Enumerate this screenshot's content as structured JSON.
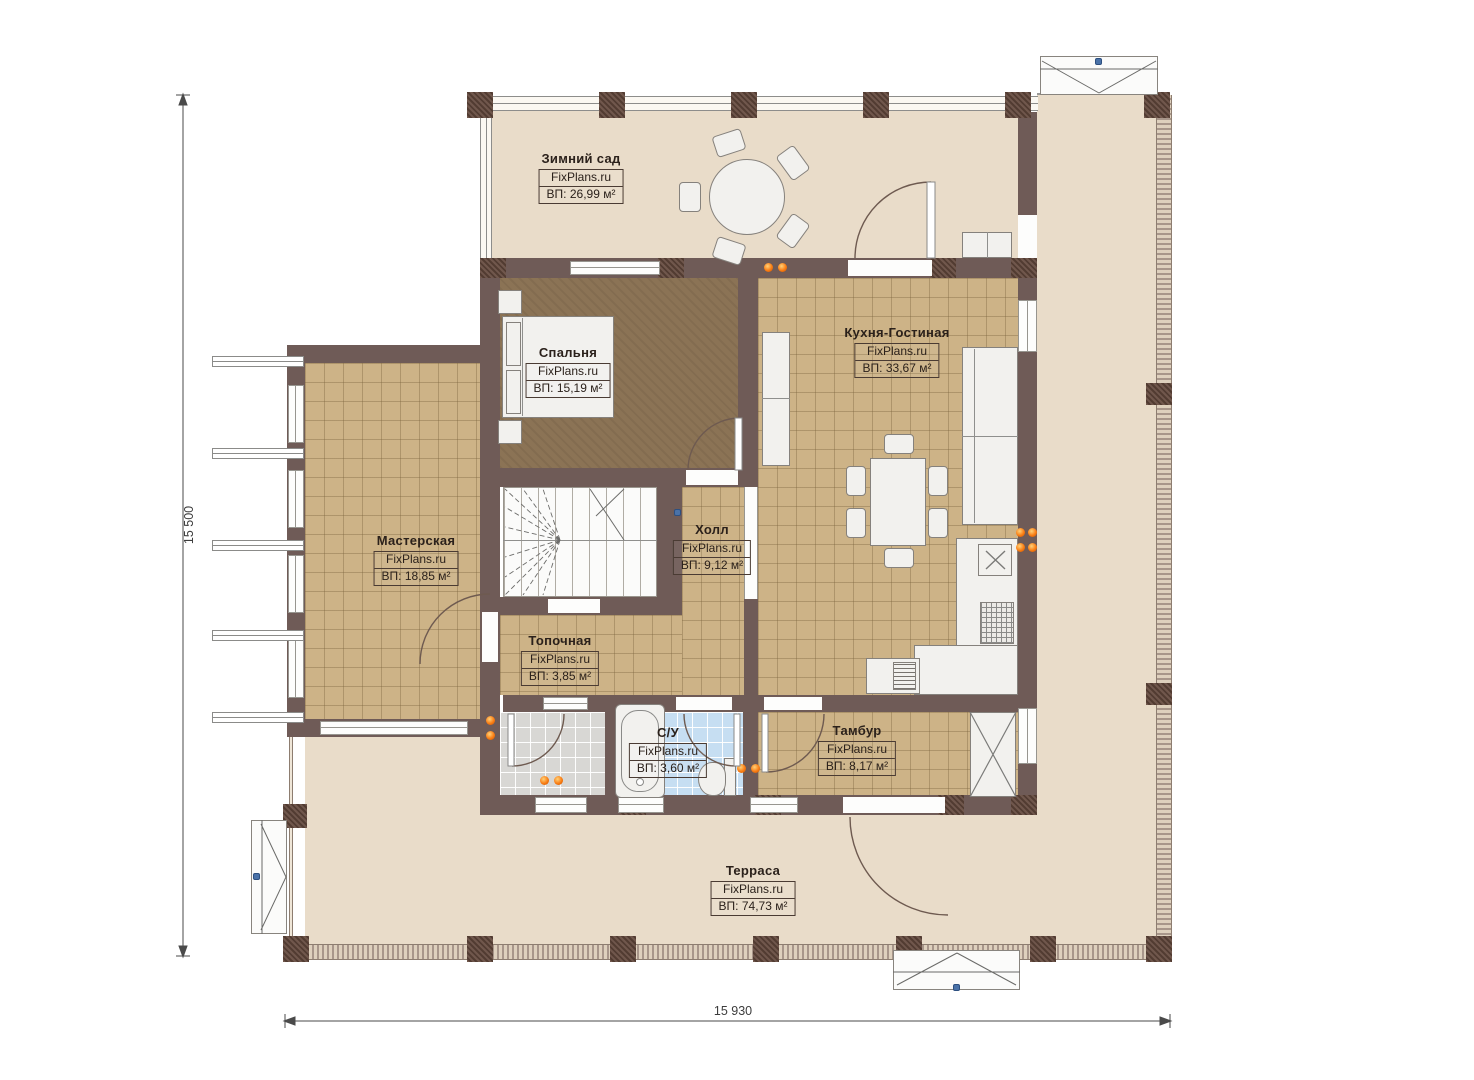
{
  "plan": {
    "brand": "FixPlans.ru",
    "rooms": [
      {
        "name": "Зимний сад",
        "watermark": "FixPlans.ru",
        "area": "ВП: 26,99 м²"
      },
      {
        "name": "Спальня",
        "watermark": "FixPlans.ru",
        "area": "ВП: 15,19 м²"
      },
      {
        "name": "Кухня-Гостиная",
        "watermark": "FixPlans.ru",
        "area": "ВП: 33,67 м²"
      },
      {
        "name": "Мастерская",
        "watermark": "FixPlans.ru",
        "area": "ВП: 18,85 м²"
      },
      {
        "name": "Холл",
        "watermark": "FixPlans.ru",
        "area": "ВП: 9,12 м²"
      },
      {
        "name": "Топочная",
        "watermark": "FixPlans.ru",
        "area": "ВП: 3,85 м²"
      },
      {
        "name": "С/У",
        "watermark": "FixPlans.ru",
        "area": "ВП: 3,60 м²"
      },
      {
        "name": "Тамбур",
        "watermark": "FixPlans.ru",
        "area": "ВП: 8,17 м²"
      },
      {
        "name": "Терраса",
        "watermark": "FixPlans.ru",
        "area": "ВП: 74,73 м²"
      }
    ],
    "dimensions": {
      "left_total": "15 500",
      "bottom_total": "15 930"
    },
    "colors": {
      "wall": "#6f5b57",
      "terrace_floor": "#e9dcc9",
      "tile_tan": "#cdb387",
      "bedroom_carpet": "#8b7355",
      "tile_blue": "#c6def2",
      "tile_gray": "#d8d7d4",
      "radiator_orange": "#f97c12",
      "marker_blue": "#4a72a8"
    }
  }
}
